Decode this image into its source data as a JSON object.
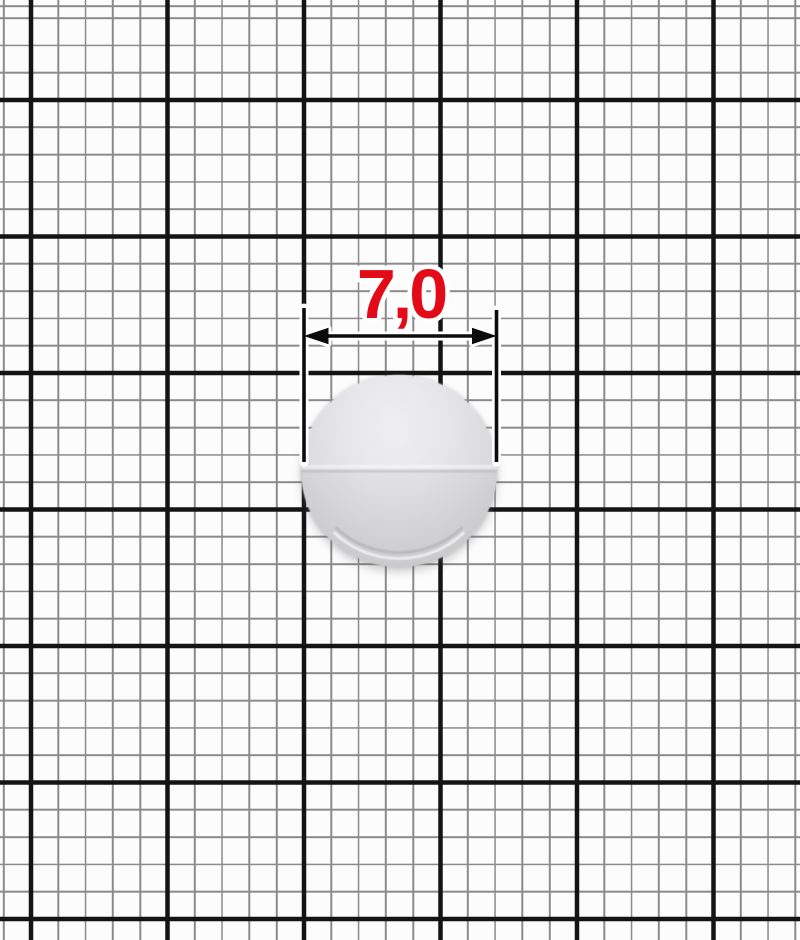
{
  "scene": {
    "type": "product-photo-with-measurement",
    "background": "millimeter-graph-paper"
  },
  "paper": {
    "paper_color": "#fcfcfc",
    "thin_line_color": "#8b8b8b",
    "bold_line_color": "#141414"
  },
  "object": {
    "name": "round-button",
    "fill_top": "#efeff1",
    "fill_bottom": "#cbcbcd"
  },
  "annotation": {
    "dimension_label": "7,0",
    "label_color": "#e30b17",
    "line_color": "#0c0c0c"
  }
}
